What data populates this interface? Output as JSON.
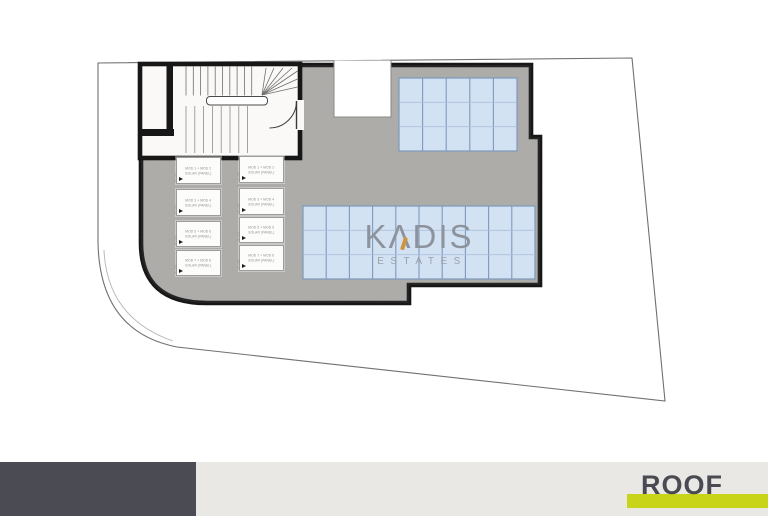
{
  "page": {
    "background": "#ffffff"
  },
  "watermark": {
    "brand_k": "K",
    "brand_a": "Λ",
    "brand_rest": "DIS",
    "subtitle": "ESTATES",
    "brand_color": "#8d939c",
    "accent_color": "#cf9440"
  },
  "footer": {
    "label": "ROOF",
    "label_color": "#4a4a52",
    "highlight_color": "#c7d417",
    "dark_block_color": "#4b4b54",
    "band_color": "#e9e8e4"
  },
  "plan": {
    "deck_color": "#b2b0ad",
    "outline_color": "#171717",
    "boundary_color": "#707070",
    "stair_floor_color": "#faf9f7",
    "solar_panel_color": "#d3e2f3",
    "solar_grid_major_color": "#7d99bd",
    "solar_grid_minor_color": "#a9c0dc",
    "arrays": [
      {
        "name": "solar-array-top-right",
        "cols": 5,
        "rows": 3
      },
      {
        "name": "solar-array-center",
        "cols": 10,
        "rows": 3
      }
    ],
    "units": [
      {
        "line1": "MOD 1 + MOD 2",
        "line2": "SOLAR (PANEL)",
        "side": "S-01"
      },
      {
        "line1": "MOD 3 + MOD 4",
        "line2": "SOLAR (PANEL)",
        "side": "S-02"
      },
      {
        "line1": "MOD 5 + MOD 6",
        "line2": "SOLAR (PANEL)",
        "side": "S-03"
      },
      {
        "line1": "MOD 7 + MOD 8",
        "line2": "SOLAR (PANEL)",
        "side": "S-04"
      },
      {
        "line1": "MOD 1 + MOD 2",
        "line2": "SOLAR (PANEL)",
        "side": "S-05"
      },
      {
        "line1": "MOD 3 + MOD 4",
        "line2": "SOLAR (PANEL)",
        "side": "S-06"
      },
      {
        "line1": "MOD 5 + MOD 6",
        "line2": "SOLAR (PANEL)",
        "side": "S-07"
      },
      {
        "line1": "MOD 7 + MOD 8",
        "line2": "SOLAR (PANEL)",
        "side": "S-08"
      }
    ]
  }
}
